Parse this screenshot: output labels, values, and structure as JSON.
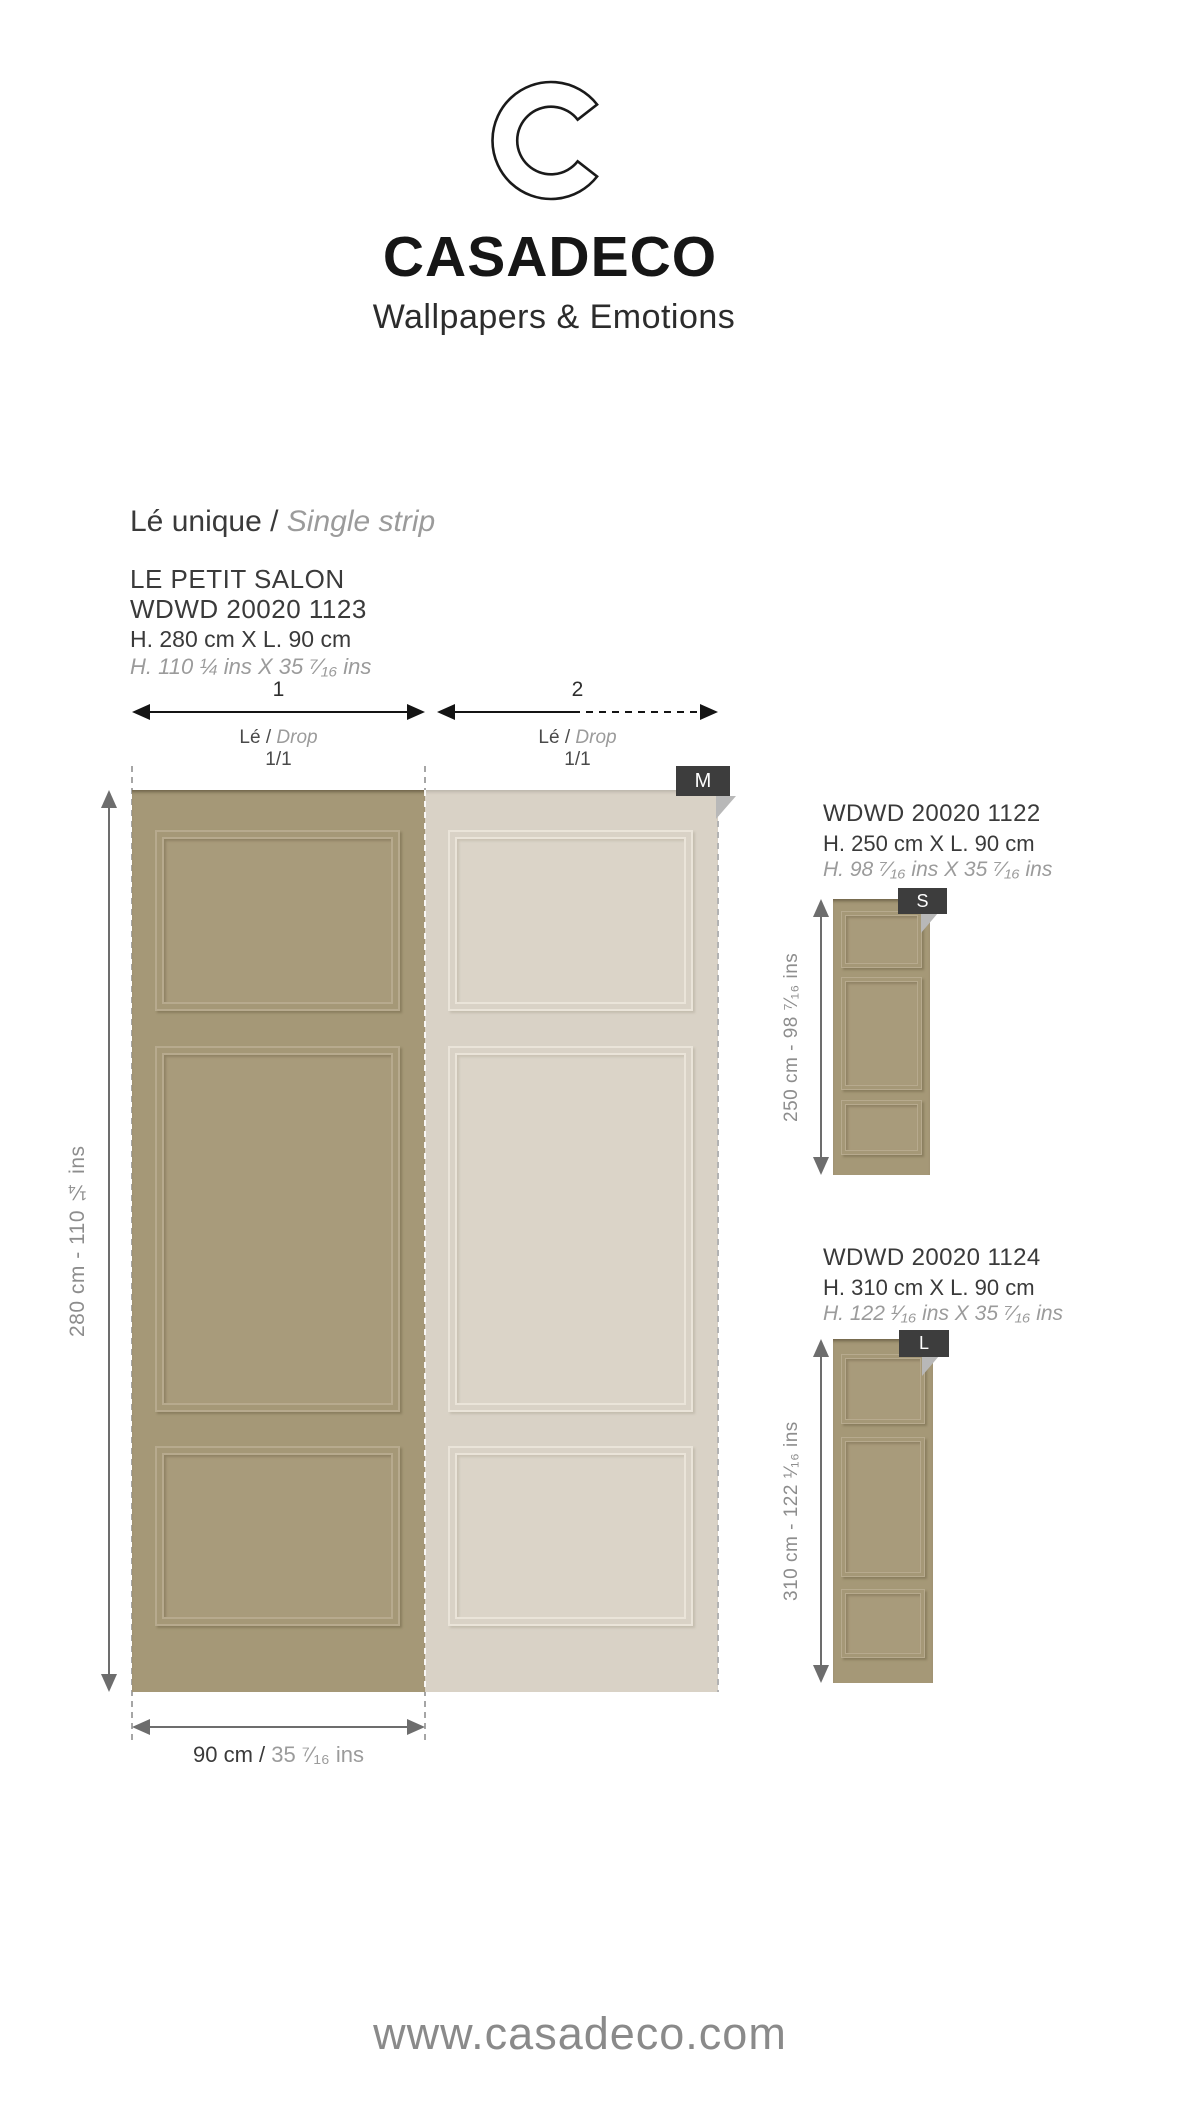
{
  "brand": {
    "logo_letter": "C",
    "name": "CASADECO",
    "tagline": "Wallpapers & Emotions",
    "website": "www.casadeco.com"
  },
  "section": {
    "title_fr": "Lé unique / ",
    "title_en": "Single strip"
  },
  "main_product": {
    "name": "LE PETIT SALON",
    "ref": "WDWD 20020 1123",
    "size_cm": "H. 280 cm X L. 90 cm",
    "size_ins": "H. 110 ¼ ins X 35 ⁷⁄₁₆ ins",
    "height_label": "280 cm - 110 ¼ ins",
    "width_cm": "90 cm / ",
    "width_ins": "35 ⁷⁄₁₆ ins",
    "badge": "M",
    "strips": [
      {
        "number": "1",
        "drop_fr": "Lé / ",
        "drop_en": "Drop",
        "ratio": "1/1"
      },
      {
        "number": "2",
        "drop_fr": "Lé / ",
        "drop_en": "Drop",
        "ratio": "1/1"
      }
    ]
  },
  "variants": [
    {
      "ref": "WDWD 20020 1122",
      "size_cm": "H. 250 cm X L. 90 cm",
      "size_ins": "H. 98 ⁷⁄₁₆ ins X 35 ⁷⁄₁₆ ins",
      "height_label": "250 cm - 98 ⁷⁄₁₆ ins",
      "badge": "S"
    },
    {
      "ref": "WDWD 20020 1124",
      "size_cm": "H. 310 cm X L. 90 cm",
      "size_ins": "H. 122 ¹⁄₁₆ ins X 35 ⁷⁄₁₆ ins",
      "height_label": "310 cm - 122 ¹⁄₁₆ ins",
      "badge": "L"
    }
  ],
  "colors": {
    "strip_dark": "#a59877",
    "strip_light": "#d9d2c6",
    "badge_bg": "#3d3d3d",
    "arrow_gray": "#6d6d6d",
    "text_dark": "#3a3a3a",
    "text_gray": "#9b9b9b"
  }
}
